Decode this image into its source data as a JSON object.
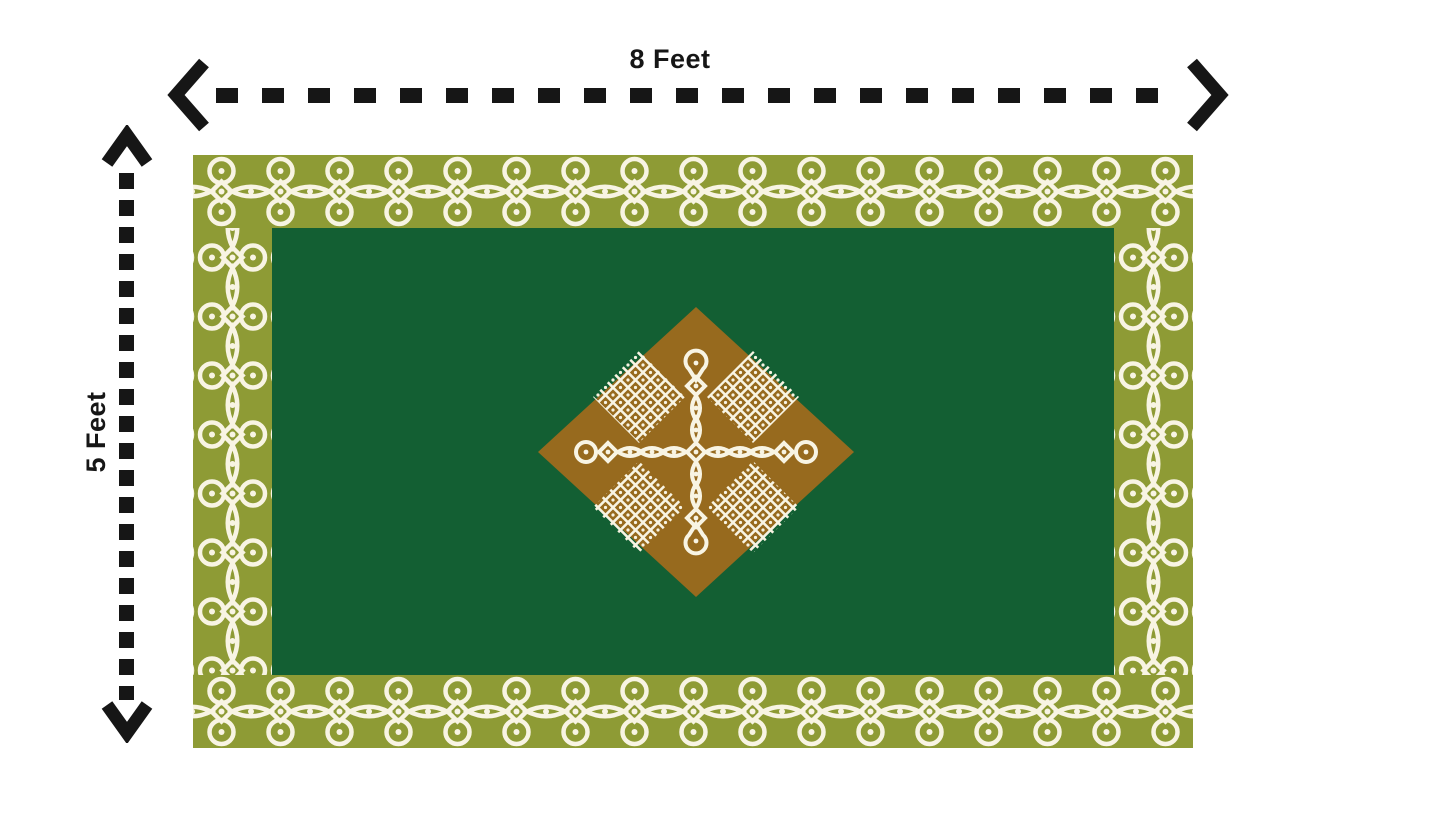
{
  "dimensions": {
    "width": {
      "label": "8 Feet",
      "orientation": "horizontal"
    },
    "height": {
      "label": "5 Feet",
      "orientation": "vertical"
    }
  },
  "icons": {
    "left_arrowhead": "chevron-left",
    "right_arrowhead": "chevron-right",
    "up_arrowhead": "chevron-up",
    "down_arrowhead": "chevron-down"
  },
  "colors": {
    "arrow": "#161616",
    "mat_border_olive": "#8e9b35",
    "mat_field_green": "#135f33",
    "center_diamond_brown": "#976a1e",
    "kolam_cream": "#f8f4e3",
    "background": "#ffffff"
  }
}
